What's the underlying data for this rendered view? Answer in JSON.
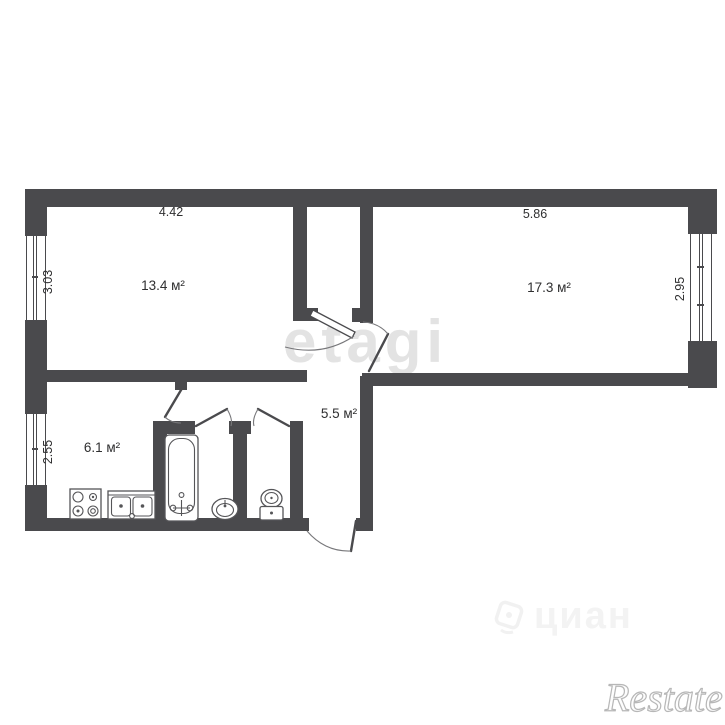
{
  "watermarks": {
    "etagi": "etagi",
    "cian": "циан",
    "restate": "Restate"
  },
  "rooms": {
    "room1": {
      "name": "living-room-left",
      "area": "13.4 м²",
      "width": "4.42",
      "depth": "3.03"
    },
    "room2": {
      "name": "living-room-right",
      "area": "17.3 м²",
      "width": "5.86",
      "depth": "2.95"
    },
    "kitchen": {
      "name": "kitchen",
      "area": "6.1 м²",
      "depth": "2.55"
    },
    "hallway": {
      "name": "hallway",
      "area": "5.5 м²"
    }
  },
  "colors": {
    "wall": "#4a4a4d",
    "background": "#ffffff",
    "text": "#2f2f30",
    "watermark_light": "#e3e3e3",
    "watermark_faint": "#f3f3f3"
  }
}
